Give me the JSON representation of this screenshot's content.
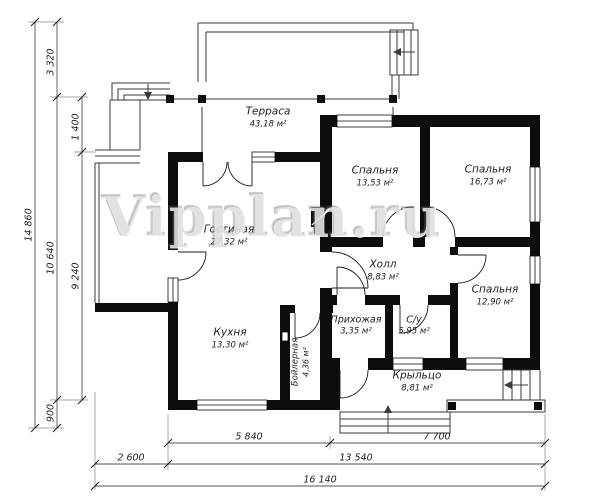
{
  "watermark": "Vipplan.ru",
  "rooms": {
    "terrace": {
      "name": "Терраса",
      "area": "43,18 м²"
    },
    "bedroom1": {
      "name": "Спальня",
      "area": "13,53 м²"
    },
    "bedroom2": {
      "name": "Спальня",
      "area": "16,73 м²"
    },
    "living": {
      "name": "Гостиная",
      "area": "27,32 м²"
    },
    "hall": {
      "name": "Холл",
      "area": "8,83 м²"
    },
    "bedroom3": {
      "name": "Спальня",
      "area": "12,90 м²"
    },
    "kitchen": {
      "name": "Кухня",
      "area": "13,30 м²"
    },
    "entry": {
      "name": "Прихожая",
      "area": "3,35 м²"
    },
    "bathroom": {
      "name": "С/у",
      "area": "5,95 м²"
    },
    "boiler": {
      "name": "Бойлерная",
      "area": "4,36 м²"
    },
    "porch": {
      "name": "Крыльцо",
      "area": "8,81 м²"
    }
  },
  "dimensions": {
    "left_total": "14 860",
    "left_upper": "3 320",
    "left_span": "10 640",
    "left_lower": "900",
    "left_terrace": "1 400",
    "left_house": "9 240",
    "bottom_left": "2 600",
    "bottom_house": "5 840",
    "bottom_porch": "7 700",
    "bottom_span": "13 540",
    "bottom_total": "16 140"
  }
}
